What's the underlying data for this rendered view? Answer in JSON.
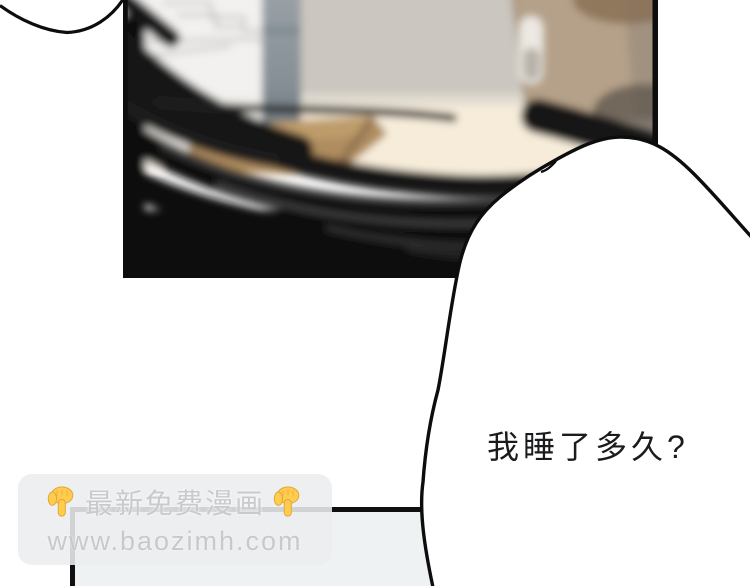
{
  "comic": {
    "speech_bubble": {
      "text": "我睡了多久?",
      "fill": "#ffffff",
      "outline": "#0d0d0d"
    },
    "watermark": {
      "title": "最新免费漫画",
      "url": "www.baozimh.com",
      "emoji": "point-down-finger",
      "background": "#ecedee",
      "text_color": "#c7cbcd",
      "emoji_yellow": "#ffcc4d",
      "emoji_outline": "#e3a63c"
    },
    "scene": {
      "ink": "#0d0d0d",
      "wall_beige": "#cbc6bf",
      "wall_white": "#f2f1ef",
      "cabinet_tan": "#b5a189",
      "cabinet_handle": "#ece8e2",
      "floor_cream": "#f7ecda",
      "pillar_gray": "#99a1a7",
      "box_brown": "#b08d60",
      "scribble_dark": "#0b0b0b",
      "bottom_panel_fill": "#eef2f2"
    }
  }
}
